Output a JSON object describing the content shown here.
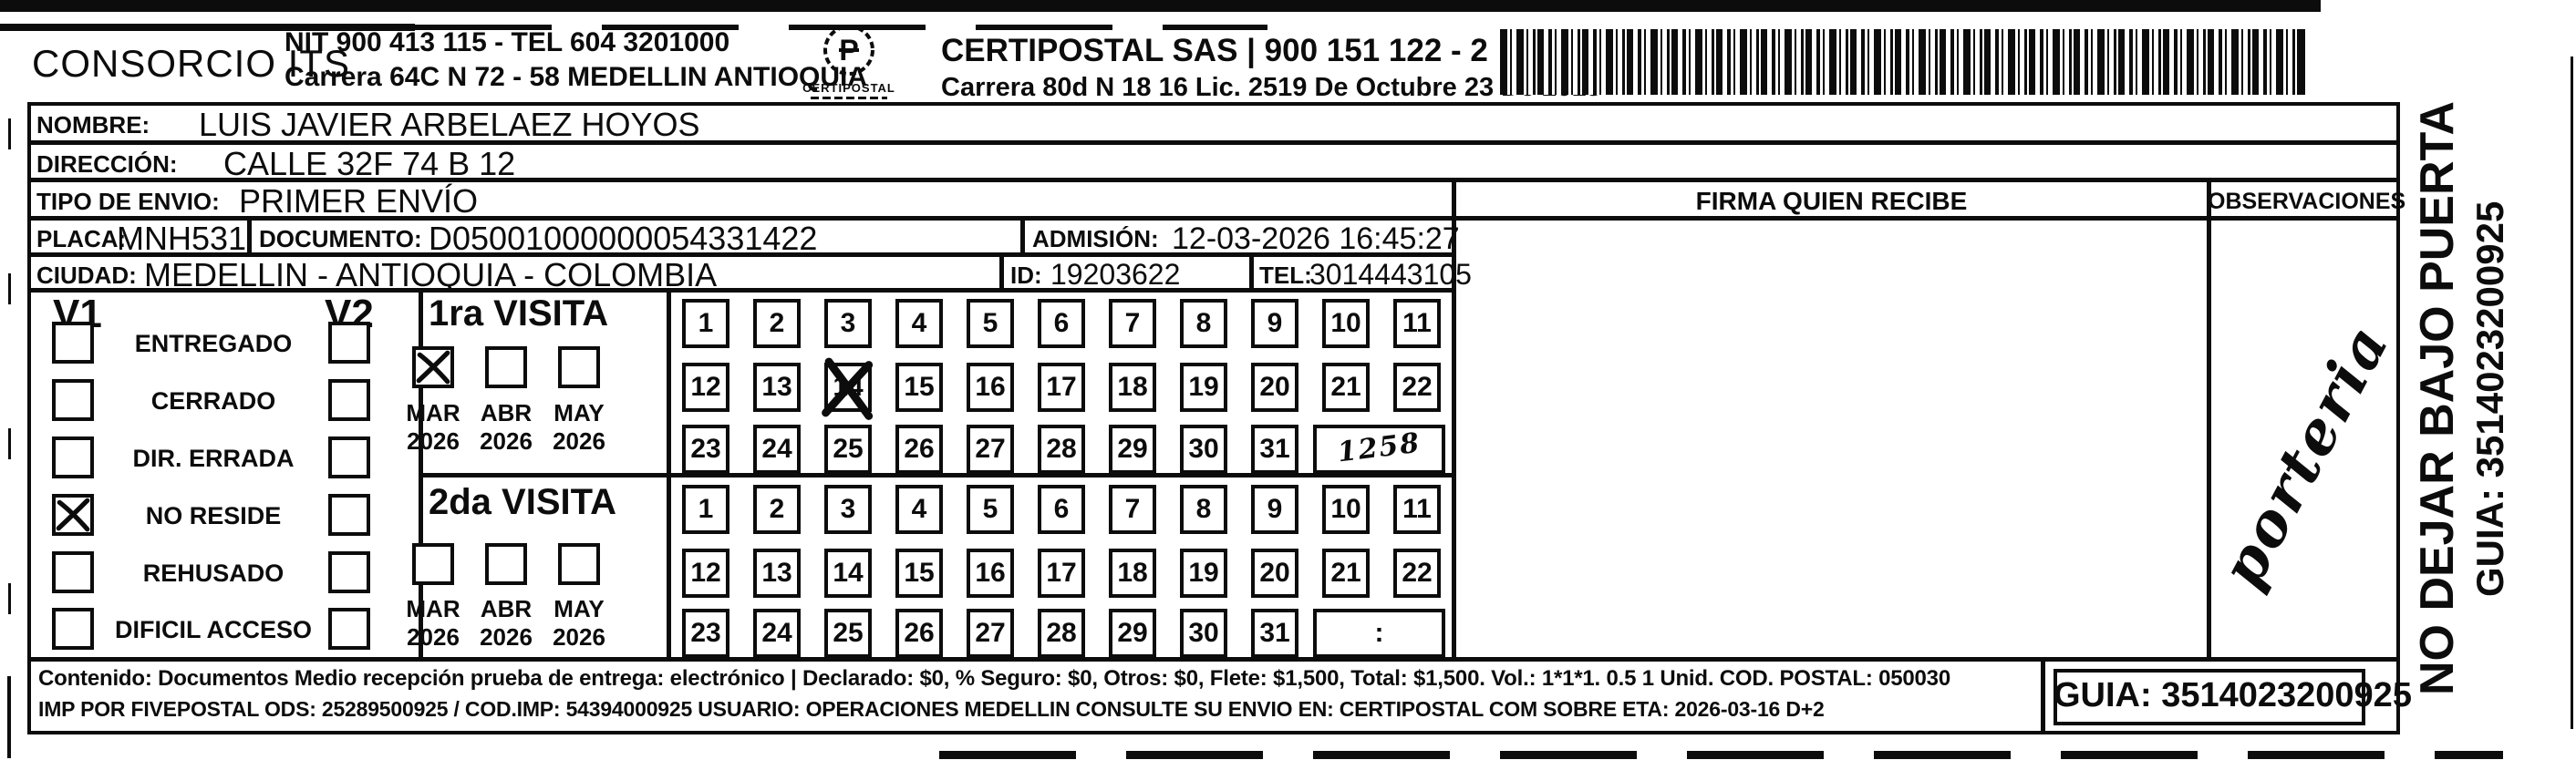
{
  "colors": {
    "ink": "#0c0c0c",
    "paper": "#ffffff"
  },
  "sender": {
    "company": "CONSORCIO ITS",
    "nit_line": "NIT 900 413 115 - TEL 604 3201000",
    "address_line": "Carrera 64C N 72 - 58 MEDELLIN ANTIOQUIA",
    "logo_caption": "CERTIPOSTAL",
    "certipostal_line": "CERTIPOSTAL SAS | 900 151 122 - 2",
    "certipostal_address": "Carrera 80d N 18 16  Lic. 2519 De Octubre 23 De 2015"
  },
  "fields": {
    "nombre_label": "NOMBRE:",
    "nombre": "LUIS JAVIER ARBELAEZ HOYOS",
    "direccion_label": "DIRECCIÓN:",
    "direccion": "CALLE 32F 74 B 12",
    "tipo_label": "TIPO DE ENVIO:",
    "tipo": "PRIMER ENVÍO",
    "placa_label": "PLACA:",
    "placa": "MNH531",
    "documento_label": "DOCUMENTO:",
    "documento": "D05001000000054331422",
    "admision_label": "ADMISIÓN:",
    "admision": "12-03-2026 16:45:27",
    "ciudad_label": "CIUDAD:",
    "ciudad": "MEDELLIN - ANTIOQUIA - COLOMBIA",
    "id_label": "ID:",
    "id_value": "19203622",
    "tel_label": "TEL:",
    "tel": "3014443105"
  },
  "headers": {
    "firma": "FIRMA QUIEN RECIBE",
    "observaciones": "OBSERVACIONES"
  },
  "status": {
    "col1": "V1",
    "col2": "V2",
    "options": [
      "ENTREGADO",
      "CERRADO",
      "DIR. ERRADA",
      "NO RESIDE",
      "REHUSADO",
      "DIFICIL ACCESO"
    ],
    "v1_checked_option": "NO RESIDE"
  },
  "visits": [
    {
      "title": "1ra VISITA",
      "months": [
        "MAR",
        "ABR",
        "MAY"
      ],
      "years": [
        "2026",
        "2026",
        "2026"
      ],
      "checked_month": "MAR",
      "day_rows": [
        [
          1,
          2,
          3,
          4,
          5,
          6,
          7,
          8,
          9,
          10,
          11
        ],
        [
          12,
          13,
          14,
          15,
          16,
          17,
          18,
          19,
          20,
          21,
          22
        ],
        [
          23,
          24,
          25,
          26,
          27,
          28,
          29,
          30,
          31
        ]
      ],
      "crossed_day": 14,
      "time_box": "1258",
      "time_handwritten": true
    },
    {
      "title": "2da VISITA",
      "months": [
        "MAR",
        "ABR",
        "MAY"
      ],
      "years": [
        "2026",
        "2026",
        "2026"
      ],
      "checked_month": null,
      "day_rows": [
        [
          1,
          2,
          3,
          4,
          5,
          6,
          7,
          8,
          9,
          10,
          11
        ],
        [
          12,
          13,
          14,
          15,
          16,
          17,
          18,
          19,
          20,
          21,
          22
        ],
        [
          23,
          24,
          25,
          26,
          27,
          28,
          29,
          30,
          31
        ]
      ],
      "crossed_day": null,
      "time_box": ":",
      "time_handwritten": false
    }
  ],
  "handwriting": {
    "observaciones_note": "porteria"
  },
  "side": {
    "warning": "NO DEJAR BAJO PUERTA",
    "guia": "GUIA: 3514023200925"
  },
  "footer": {
    "line1": "Contenido: Documentos Medio recepción prueba de entrega: electrónico | Declarado: $0, % Seguro: $0, Otros: $0, Flete: $1,500, Total: $1,500. Vol.: 1*1*1. 0.5  1 Unid. COD. POSTAL: 050030",
    "line2": "IMP POR FIVEPOSTAL ODS: 25289500925 / COD.IMP: 54394000925 USUARIO: OPERACIONES MEDELLIN CONSULTE SU ENVIO EN: CERTIPOSTAL COM SOBRE ETA: 2026-03-16 D+2",
    "guia_box": "GUIA: 3514023200925"
  }
}
